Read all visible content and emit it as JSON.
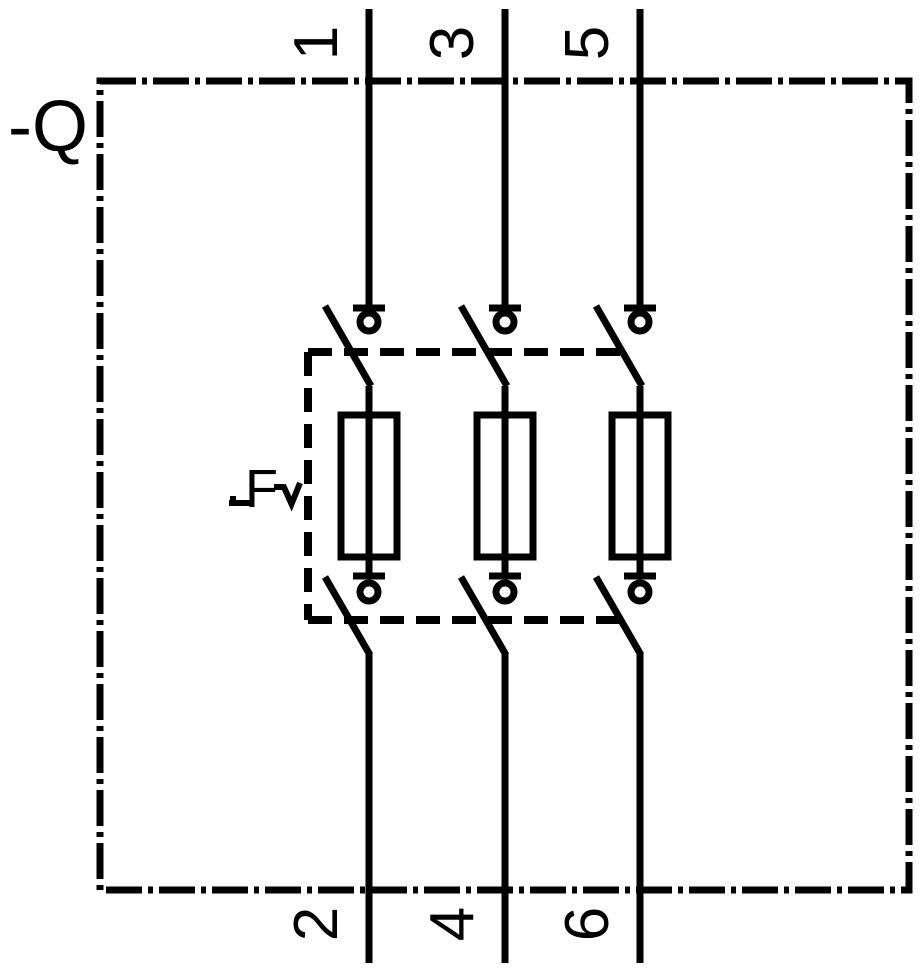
{
  "diagram": {
    "type": "electrical-schematic-symbol",
    "subject": "Three-pole fuse switch-disconnector (switch-fuse) with double-break contacts",
    "device_label": "-Q",
    "fuse_unit_label": "F",
    "terminals": {
      "top": [
        "1",
        "3",
        "5"
      ],
      "bottom": [
        "2",
        "4",
        "6"
      ]
    },
    "poles": [
      {
        "top_terminal": "1",
        "bottom_terminal": "2"
      },
      {
        "top_terminal": "3",
        "bottom_terminal": "4"
      },
      {
        "top_terminal": "5",
        "bottom_terminal": "6"
      }
    ],
    "style": {
      "line_color": "#000000",
      "background_color": "#ffffff"
    }
  }
}
